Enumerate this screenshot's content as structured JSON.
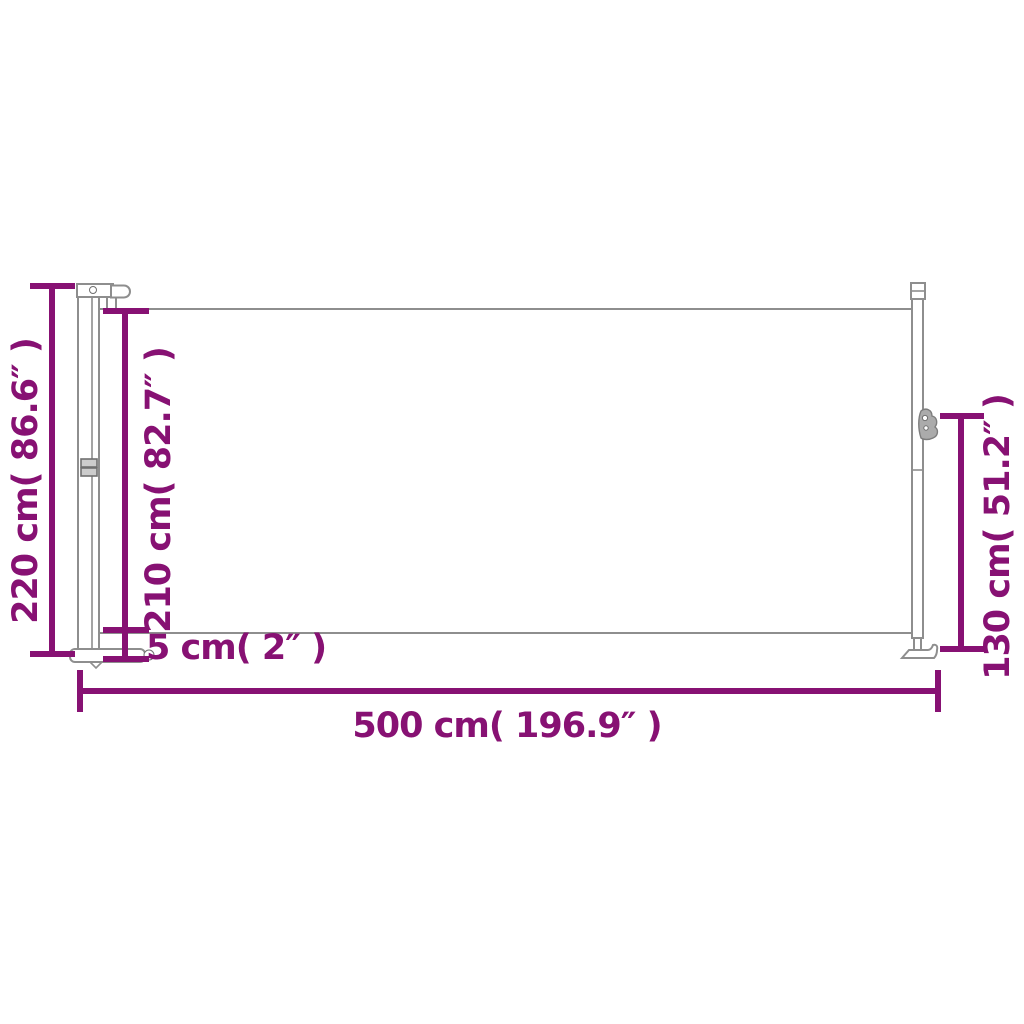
{
  "diagram": {
    "type": "product-dimension-drawing",
    "subject": "retractable side awning - side view",
    "colors": {
      "dimension_color": "#871173",
      "outline_color": "#8e8e8e",
      "background_color": "#ffffff"
    },
    "labels": {
      "total_height": "220 cm( 86.6″ )",
      "fabric_height": "210 cm( 82.7″ )",
      "ground_clearance": "5 cm( 2″ )",
      "total_width": "500 cm( 196.9″ )",
      "front_post_height": "130 cm( 51.2″ )"
    }
  }
}
